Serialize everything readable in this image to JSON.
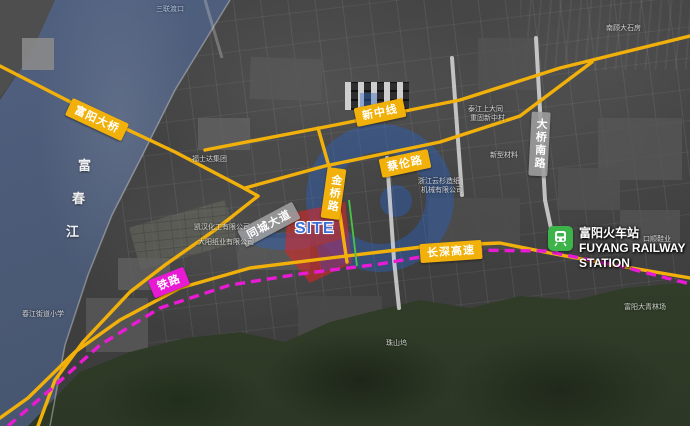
{
  "map": {
    "type": "satellite-road-overlay",
    "site_label": "SITE",
    "river": {
      "name_chars": [
        "富",
        "春",
        "江"
      ]
    },
    "station": {
      "name_cn": "富阳火车站",
      "name_en_line1": "FUYANG RAILWAY",
      "name_en_line2": "STATION",
      "icon": "train-icon"
    },
    "road_labels": {
      "fuyang_bridge": "富阳大桥",
      "xinzhong_line": "新中线",
      "cailun_road": "蔡伦路",
      "jinqiao_road": "金桥路",
      "changshen_expressway": "长深高速",
      "railway": "铁路",
      "daqiao_south_road": "大桥南路",
      "tongcheng_avenue": "同城大道"
    },
    "poi_labels": [
      {
        "text": "三联渡口"
      },
      {
        "text": "福士达集团"
      },
      {
        "text": "泰江上大同"
      },
      {
        "text": "重固新中村"
      },
      {
        "text": "新型材料"
      },
      {
        "text": "浙江云杉造纸"
      },
      {
        "text": "机械有限公司"
      },
      {
        "text": "凯汉化工有限公司"
      },
      {
        "text": "大阳纸业有限公司"
      },
      {
        "text": "春江街道小学"
      },
      {
        "text": "南顾大石房"
      },
      {
        "text": "口顺鞋业"
      },
      {
        "text": "富阳大青林场"
      },
      {
        "text": "珠山坞"
      }
    ],
    "colors": {
      "road_yellow": "#F2B10A",
      "railway_magenta": "#E91AD4",
      "site_red": "#E32525",
      "site_text_blue": "#3D6FD6",
      "watermark_blue": "#2A64C8",
      "station_green": "#3CB44A",
      "river_blue": "#4C5B77",
      "mountain_green": "#33402B",
      "gray_pill": "#9E9E9E"
    }
  }
}
